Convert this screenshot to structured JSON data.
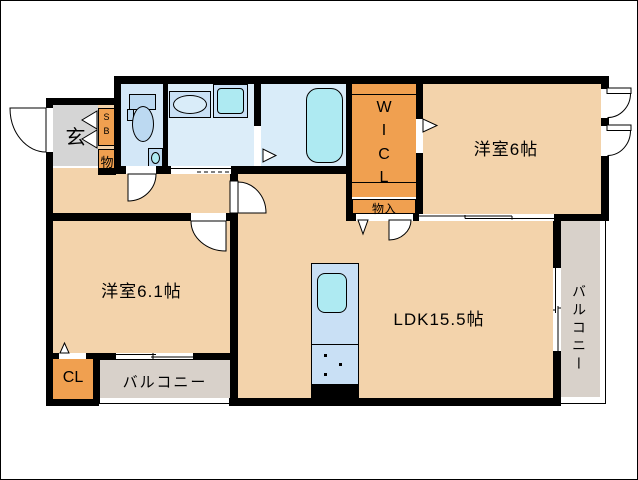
{
  "plan": {
    "type": "apartment-floor-plan",
    "labels": {
      "genkan": "玄",
      "shoe_box": [
        "S",
        "B"
      ],
      "storage_hall": "物",
      "wicl": [
        "W",
        "I",
        "C",
        "L"
      ],
      "storage_entry": "物入",
      "bedroom_east": "洋室6帖",
      "bedroom_west": "洋室6.1帖",
      "ldk": "LDK15.5帖",
      "closet": "CL",
      "balcony_south": "バルコニー",
      "balcony_east": "バルコニー"
    },
    "colors": {
      "wall": "#000000",
      "room_floor_beige": "#f3d3ab",
      "closet_orange": "#f0a050",
      "genkan_gray": "#d5d5d5",
      "balcony_gray": "#d8d1ca",
      "toilet_room_blue": "#d3e7f7",
      "washroom_blue": "#dcedf9",
      "bathroom_blue": "#d9ecf9",
      "fixture_blue": "#bcd9f1",
      "counter_blue": "#c9e0f5",
      "water_cyan": "#aeeaf2"
    },
    "fixtures": [
      "toilet",
      "toilet-hand-basin",
      "vanity-sink",
      "washing-machine-pan",
      "bathtub",
      "kitchen-counter",
      "kitchen-sink",
      "gas-stove-burners"
    ]
  }
}
